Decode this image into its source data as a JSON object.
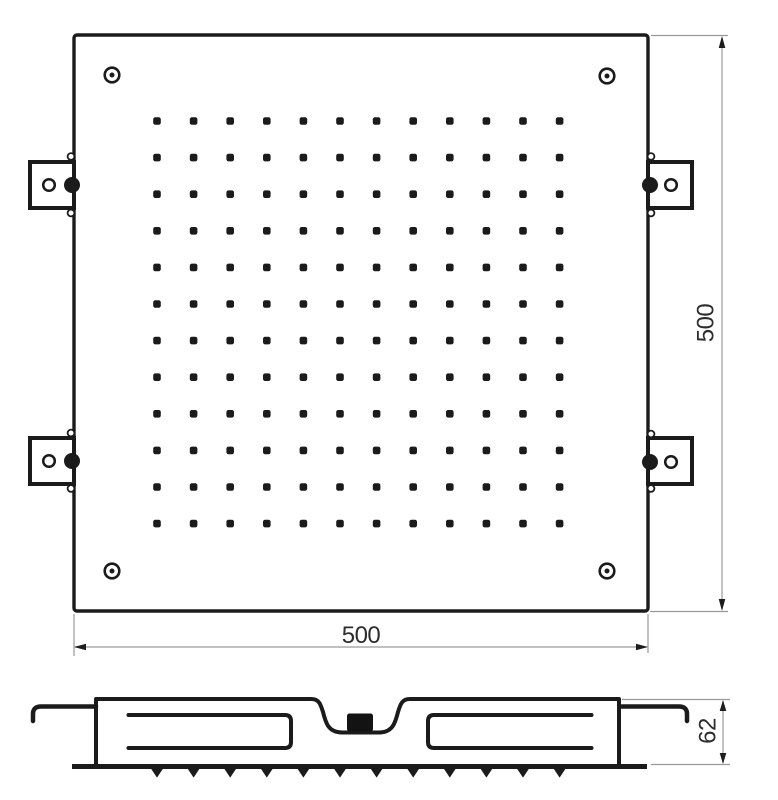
{
  "drawing": {
    "views": {
      "top_view_name": "top-view",
      "side_view_name": "side-section-view"
    }
  },
  "dimensions": {
    "bottom_width": "500",
    "right_height": "500",
    "side_depth": "62"
  },
  "colors": {
    "line": "#1b1b1b",
    "fill": "#ffffff",
    "dim_line": "#9a9a9a",
    "arrow": "#1d1d1d",
    "text": "#2d2d2d",
    "block": "#131313"
  },
  "top_view": {
    "plate": {
      "x": 74,
      "y": 35,
      "w": 574,
      "h": 576,
      "corner_radius": 3,
      "stroke_width": 3.4
    },
    "nozzle_grid": {
      "rows": 12,
      "cols": 12,
      "start_x": 157,
      "start_y": 121,
      "spacing_x": 36.6,
      "spacing_y": 36.6,
      "dot_size": 7.6,
      "dot_radius": 2.1
    },
    "corner_screws": [
      {
        "cx": 112,
        "cy": 75
      },
      {
        "cx": 607,
        "cy": 76
      },
      {
        "cx": 112,
        "cy": 571
      },
      {
        "cx": 607,
        "cy": 571
      }
    ],
    "screw_style": {
      "outer_r": 7.3,
      "ring_width": 2.6,
      "dot_r": 2.5
    },
    "mounting_brackets": [
      {
        "position": "top-left",
        "box": {
          "x": 30,
          "y": 162,
          "w": 44,
          "h": 46
        },
        "hole": {
          "cx": 49,
          "cy": 185
        },
        "pin": {
          "cx": 72,
          "cy": 185
        },
        "bumps": [
          {
            "cx": 71,
            "cy": 156.5
          },
          {
            "cx": 71,
            "cy": 213
          }
        ]
      },
      {
        "position": "top-right",
        "box": {
          "x": 648,
          "y": 162,
          "w": 44,
          "h": 46
        },
        "hole": {
          "cx": 671,
          "cy": 185
        },
        "pin": {
          "cx": 650,
          "cy": 185
        },
        "bumps": [
          {
            "cx": 651,
            "cy": 156.5
          },
          {
            "cx": 651,
            "cy": 213
          }
        ]
      },
      {
        "position": "bottom-left",
        "box": {
          "x": 30,
          "y": 438,
          "w": 44,
          "h": 46
        },
        "hole": {
          "cx": 49,
          "cy": 461
        },
        "pin": {
          "cx": 72,
          "cy": 461
        },
        "bumps": [
          {
            "cx": 71,
            "cy": 433
          },
          {
            "cx": 71,
            "cy": 488.5
          }
        ]
      },
      {
        "position": "bottom-right",
        "box": {
          "x": 648,
          "y": 438,
          "w": 44,
          "h": 46
        },
        "hole": {
          "cx": 671,
          "cy": 462
        },
        "pin": {
          "cx": 650,
          "cy": 462
        },
        "bumps": [
          {
            "cx": 651,
            "cy": 434
          },
          {
            "cx": 651,
            "cy": 488.5
          }
        ]
      }
    ],
    "bracket_style": {
      "box_stroke": 4,
      "hole_r": 5.8,
      "hole_ring": 2.5,
      "pin_r": 8,
      "bump_r": 3.4,
      "bump_ring": 1.8
    }
  },
  "side_view": {
    "nozzle_ticks": {
      "count": 12,
      "start_x": 157,
      "spacing": 36.6,
      "top_y": 768.6,
      "tip_y": 777.6,
      "half_width": 6
    }
  }
}
